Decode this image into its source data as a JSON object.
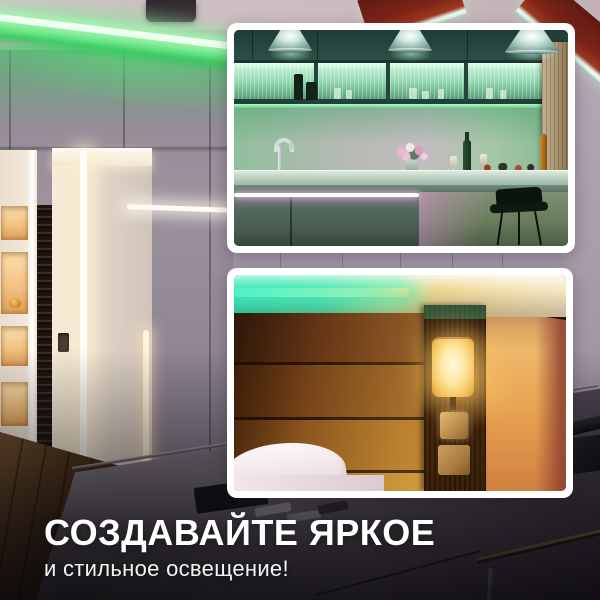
{
  "caption": {
    "title": "СОЗДАВАЙТЕ ЯРКОЕ",
    "subtitle": "и стильное освещение!"
  },
  "insets": [
    {
      "id": "kitchen",
      "label": "kitchen-with-green-under-cabinet-led"
    },
    {
      "id": "bedroom",
      "label": "bedroom-with-teal-cove-led-and-wall-lamp"
    }
  ],
  "palette": {
    "led_green": "#2fd45c",
    "led_teal": "#2ee8b5",
    "led_magenta": "#d86fd0",
    "led_white": "#fffdf6",
    "warm_lamp": "#f5c36a",
    "beam_red": "#8a2a1e",
    "wall_lilac": "#aa9dac",
    "text_color": "#ffffff",
    "overlay_dark": "#0a080a"
  }
}
